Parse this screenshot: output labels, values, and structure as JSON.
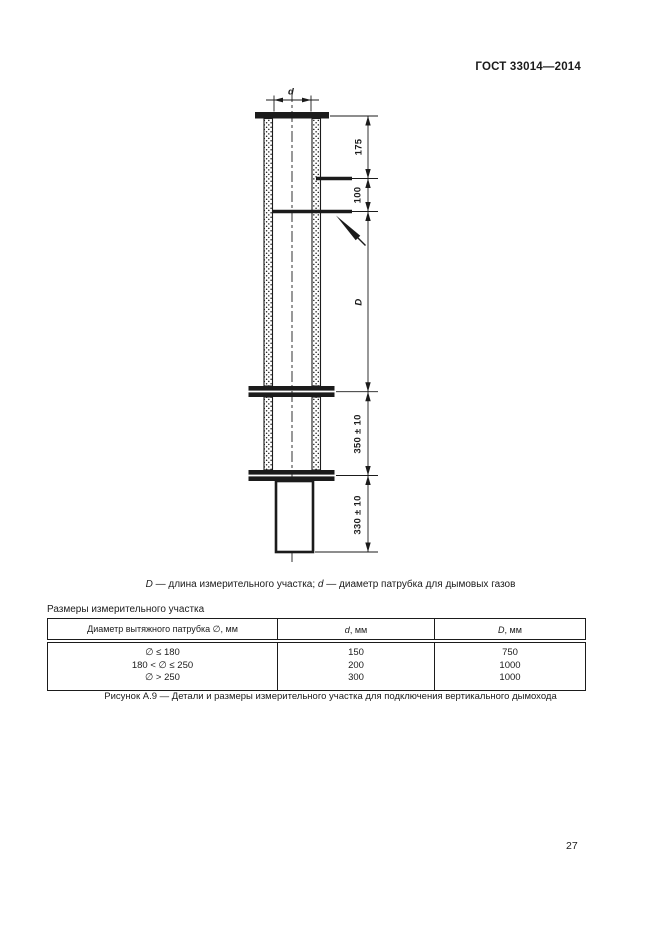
{
  "header": {
    "doc_number": "ГОСТ 33014—2014"
  },
  "drawing": {
    "dim_d": "d",
    "dim_175": "175",
    "dim_100": "100",
    "dim_D": "D",
    "dim_350": "350 ± 10",
    "dim_330": "330 ± 10"
  },
  "caption": {
    "D_var": "D",
    "D_text": " — длина измерительного участка; ",
    "d_var": "d",
    "d_text": " — диаметр патрубка для дымовых газов"
  },
  "table": {
    "title": "Размеры измерительного участка",
    "headers": {
      "col1": "Диаметр вытяжного патрубка ∅, мм",
      "col2_var": "d",
      "col2_unit": ", мм",
      "col3_var": "D",
      "col3_unit": ", мм"
    },
    "rows": [
      {
        "diameter": "∅ ≤ 180",
        "d": "150",
        "D": "750"
      },
      {
        "diameter": "180 < ∅ ≤ 250",
        "d": "200",
        "D": "1000"
      },
      {
        "diameter": "∅ > 250",
        "d": "300",
        "D": "1000"
      }
    ]
  },
  "figure_caption": "Рисунок А.9 — Детали и размеры измерительного участка для подключения вертикального дымохода",
  "page_number": "27",
  "colors": {
    "ink": "#1b1b1b",
    "paper": "#ffffff"
  }
}
